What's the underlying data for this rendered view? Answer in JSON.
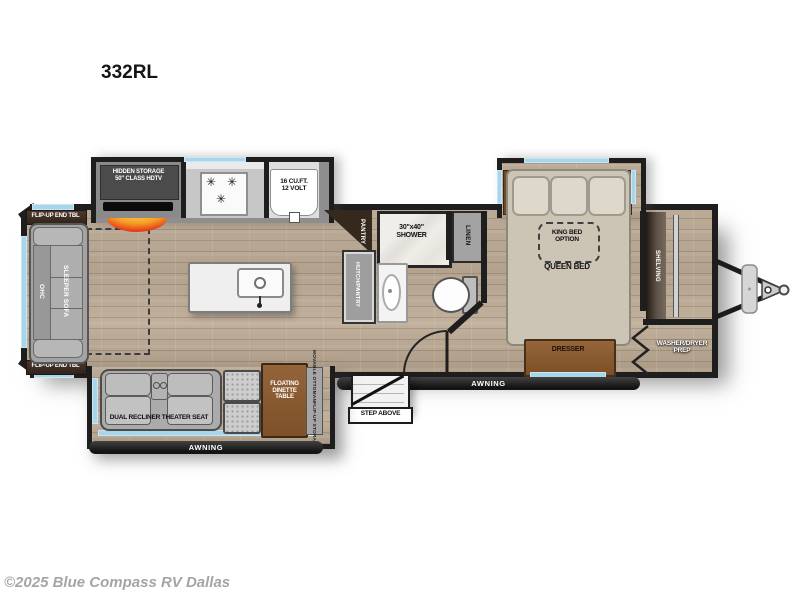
{
  "page": {
    "title": "332RL",
    "copyright": "©2025 Blue Compass RV Dallas"
  },
  "living": {
    "flip_up_end_tbl_top": "FLIP-UP END TBL",
    "flip_up_end_tbl_bottom": "FLIP-UP END TBL",
    "ohc": "OHC",
    "sleeper_sofa": "SLEEPER SOFA",
    "hidden_storage_line1": "HIDDEN STORAGE",
    "hidden_storage_line2": "50\" CLASS HDTV",
    "theater_seat": "DUAL RECLINER THEATER SEAT",
    "dinette_line1": "FLOATING",
    "dinette_line2": "DINETTE",
    "dinette_line3": "TABLE",
    "movable_ottoman_line1": "MOVABLE OTTOMAN",
    "movable_ottoman_line2": "FLIP-UP STORAGE",
    "awning_slide": "AWNING"
  },
  "kitchen": {
    "fridge_line1": "16 CU.FT.",
    "fridge_line2": "12 VOLT",
    "pantry": "PANTRY",
    "hutch_pantry": "HUTCH/PANTRY"
  },
  "bath": {
    "shower_line1": "30\"x40\"",
    "shower_line2": "SHOWER",
    "linen": "LINEN"
  },
  "bedroom": {
    "king_line1": "KING BED",
    "king_line2": "OPTION",
    "queen": "QUEEN BED",
    "dresser": "DRESSER"
  },
  "front": {
    "shelving": "SHELVING",
    "washer_dryer_line1": "WASHER/DRYER",
    "washer_dryer_line2": "PREP"
  },
  "exterior": {
    "awning_main": "AWNING",
    "step_above": "STEP ABOVE"
  },
  "icons": {
    "burner": "✳"
  },
  "colors": {
    "wall": "#1e1e1e",
    "window_blue": "#a7d6ec",
    "floor_wood": "#b7a794",
    "furniture_wood": "#8a5a31",
    "fireplace_red": "#d8340e",
    "copyright_gray": "#a5a5a5"
  }
}
